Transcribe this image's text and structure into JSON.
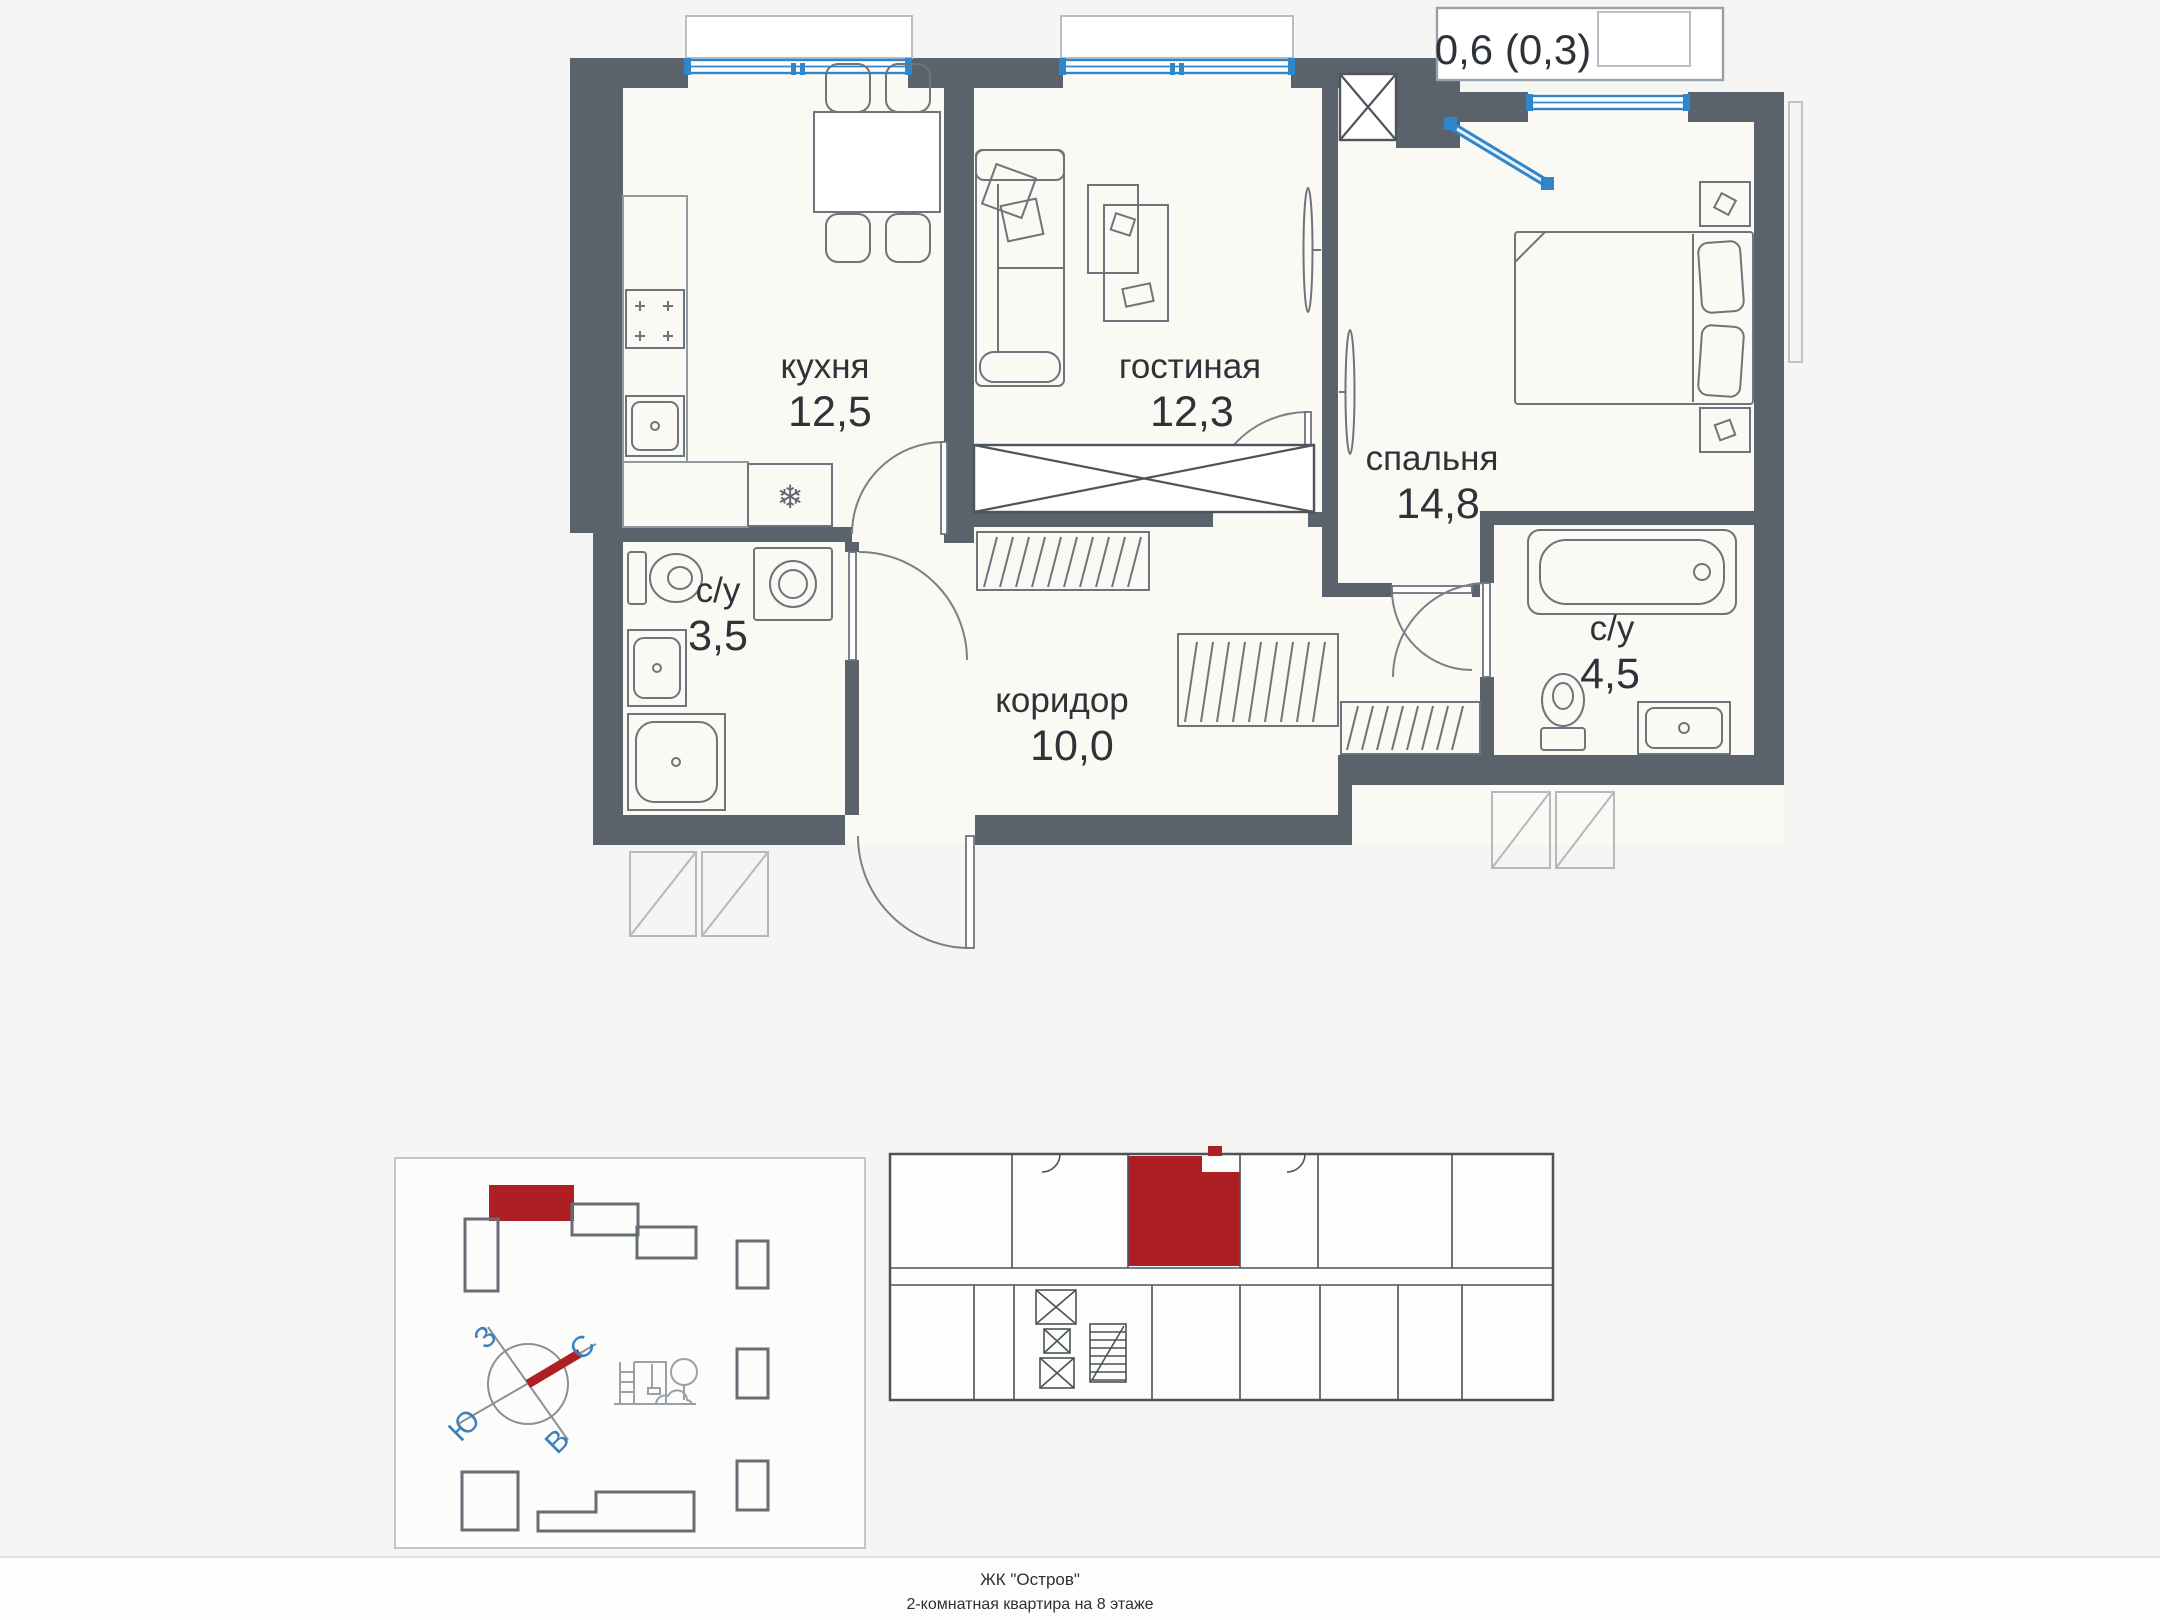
{
  "floor_plan": {
    "balcony_label": "0,6 (0,3)",
    "rooms": {
      "kitchen": {
        "name": "кухня",
        "area": "12,5"
      },
      "living": {
        "name": "гостиная",
        "area": "12,3"
      },
      "bedroom": {
        "name": "спальня",
        "area": "14,8"
      },
      "bath_small": {
        "name": "с/у",
        "area": "3,5"
      },
      "corridor": {
        "name": "коридор",
        "area": "10,0"
      },
      "bath_big": {
        "name": "с/у",
        "area": "4,5"
      }
    },
    "icons": {
      "fridge": "❄"
    }
  },
  "site_plan": {
    "compass": {
      "west": "З",
      "north": "С",
      "south": "Ю",
      "east": "В"
    }
  },
  "footer": {
    "line1": "ЖК \"Остров\"",
    "line2": "2-комнатная квартира на 8 этаже"
  },
  "colors": {
    "wall": "#5a626b",
    "window_blue": "#2f86c9",
    "accent_red": "#ad1f23",
    "floor": "#faf9f3",
    "page_bg": "#f5f5f3",
    "compass_text": "#3f7fbe"
  }
}
